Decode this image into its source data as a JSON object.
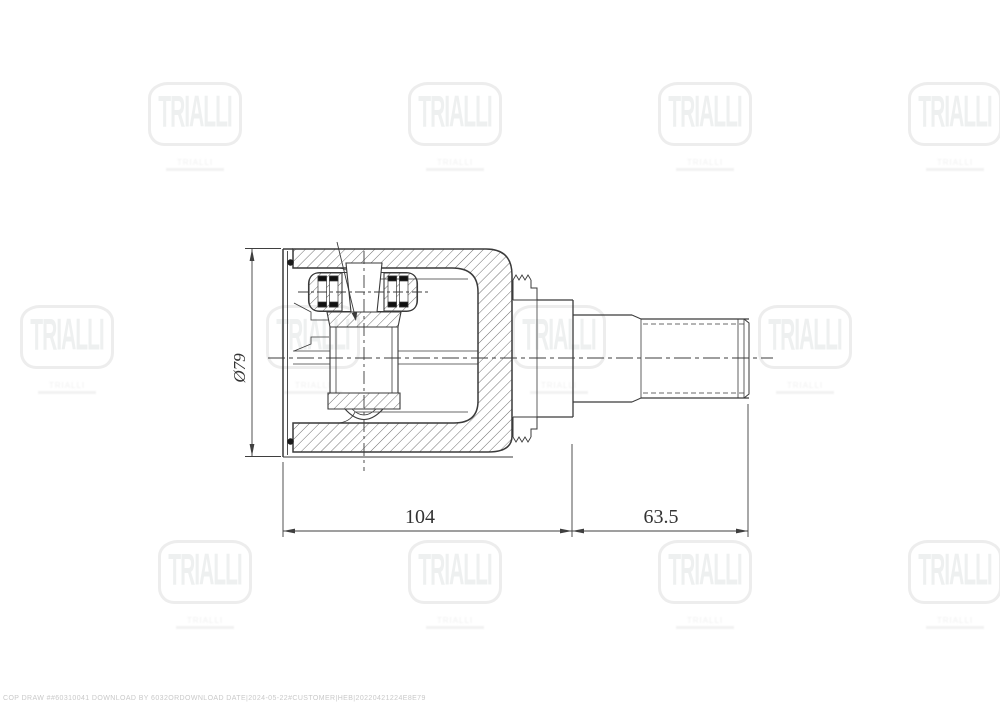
{
  "page": {
    "background": "#ffffff",
    "line_color": "#3a3a3a"
  },
  "drawing": {
    "dimension_labels": {
      "diameter": "Ø79",
      "housing_length": "104",
      "stem_length": "63.5"
    }
  },
  "watermark": {
    "brand": "TRIALLI",
    "color": "#f0f0f0"
  },
  "footer": {
    "code": "COP DRAW ##60310041 DOWNLOAD BY 6032ORDOWNLOAD DATE|2024-05-22#CUSTOMER|HEB|20220421224E8E79"
  }
}
